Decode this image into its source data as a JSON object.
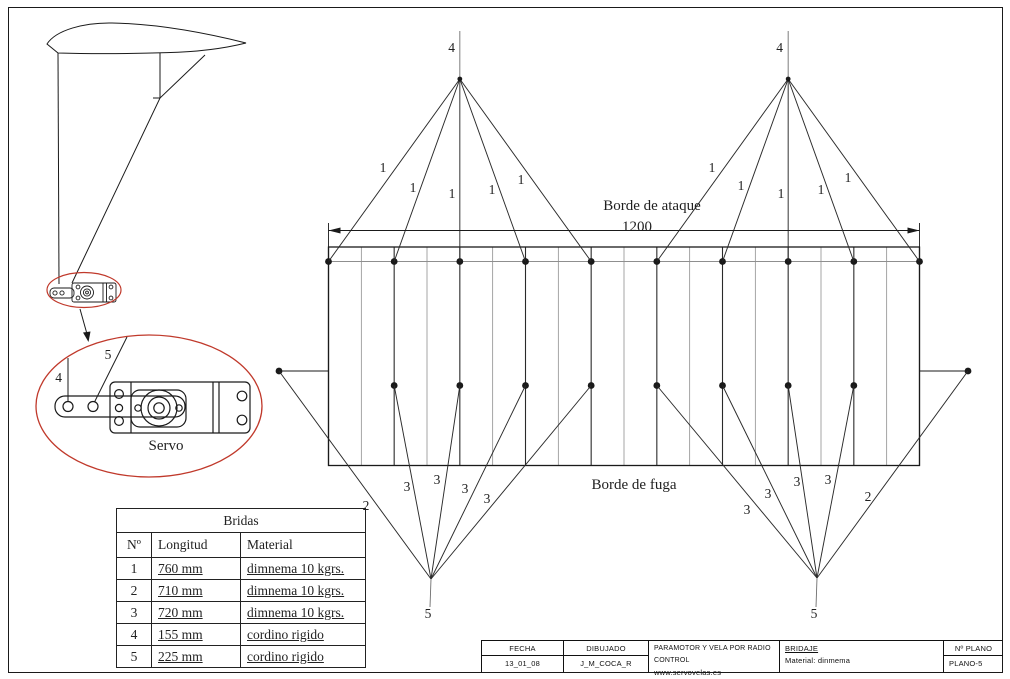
{
  "colors": {
    "line": "#1a1a1a",
    "grey": "#8f8f8f",
    "red": "#c0392b"
  },
  "drawing": {
    "leading_edge_label": "Borde de ataque",
    "span_dimension": "1200",
    "trailing_edge_label": "Borde de fuga",
    "servo_label": "Servo",
    "upper_line_number": "1",
    "tip_line_number": "2",
    "lower_line_number": "3",
    "riser_top_number": "4",
    "riser_bottom_number": "5"
  },
  "bridas_table": {
    "title": "Bridas",
    "headers": [
      "Nº",
      "Longitud",
      "Material"
    ],
    "rows": [
      [
        "1",
        "760 mm",
        "dimnema 10 kgrs."
      ],
      [
        "2",
        "710 mm",
        "dimnema 10 kgrs."
      ],
      [
        "3",
        "720 mm",
        "dimnema 10 kgrs."
      ],
      [
        "4",
        "155 mm",
        "cordino rigido"
      ],
      [
        "5",
        "225 mm",
        "cordino rigido"
      ]
    ]
  },
  "title_block": {
    "fecha_label": "FECHA",
    "fecha_value": "13_01_08",
    "dibujado_label": "DIBUJADO",
    "dibujado_value": "J_M_COCA_R",
    "project": "PARAMOTOR Y VELA POR RADIO CONTROL",
    "website": "www.servovelas.es",
    "piece": "BRIDAJE",
    "material": "Material: dinmema",
    "plano_label": "Nº PLANO",
    "plano_value": "PLANO-5"
  }
}
